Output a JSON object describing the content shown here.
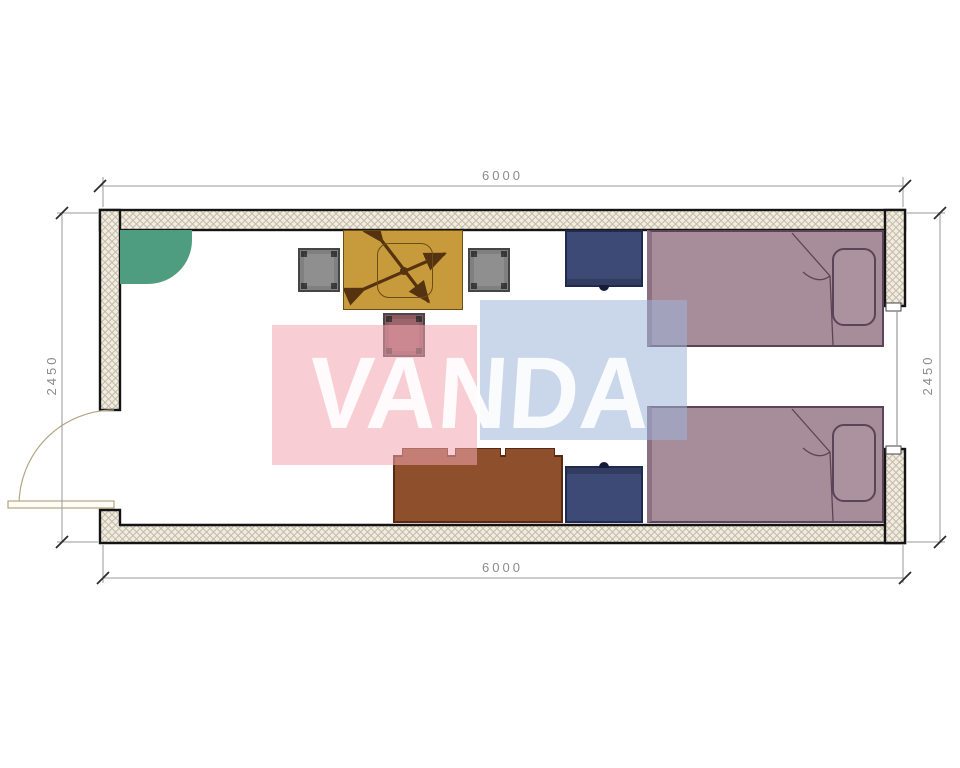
{
  "page": {
    "type": "architectural-floor-plan",
    "background": "#ffffff"
  },
  "dimensions": {
    "top": "6000",
    "bottom": "6000",
    "left": "2450",
    "right": "2450"
  },
  "watermark": {
    "text": "VANDA",
    "panel_pink_color": "#f6c9d1",
    "panel_blue_color": "#c4d2e8",
    "text_color": "#ffffff"
  },
  "walls": {
    "stroke_color": "#141414",
    "hatch_background": "#f1ece1",
    "hatch_line_color": "#c3bba6",
    "features": [
      "door-swing-left-wall",
      "window-right-wall"
    ]
  },
  "furniture": [
    {
      "name": "corner-counter",
      "color": "#4f9d80"
    },
    {
      "name": "desk-with-x-base",
      "color": "#c79a3c"
    },
    {
      "name": "chair-left",
      "color": "#8f8f8f"
    },
    {
      "name": "chair-right",
      "color": "#8f8f8f"
    },
    {
      "name": "stool",
      "color": "#9c646c"
    },
    {
      "name": "nightstand-upper",
      "color": "#3e4a76"
    },
    {
      "name": "nightstand-lower",
      "color": "#3e4a76"
    },
    {
      "name": "bed-upper",
      "color": "#a78d99"
    },
    {
      "name": "bed-lower",
      "color": "#a78d99"
    },
    {
      "name": "sideboard",
      "color": "#8d4f2c"
    },
    {
      "name": "door-leaf",
      "color": "#b3a684"
    }
  ]
}
